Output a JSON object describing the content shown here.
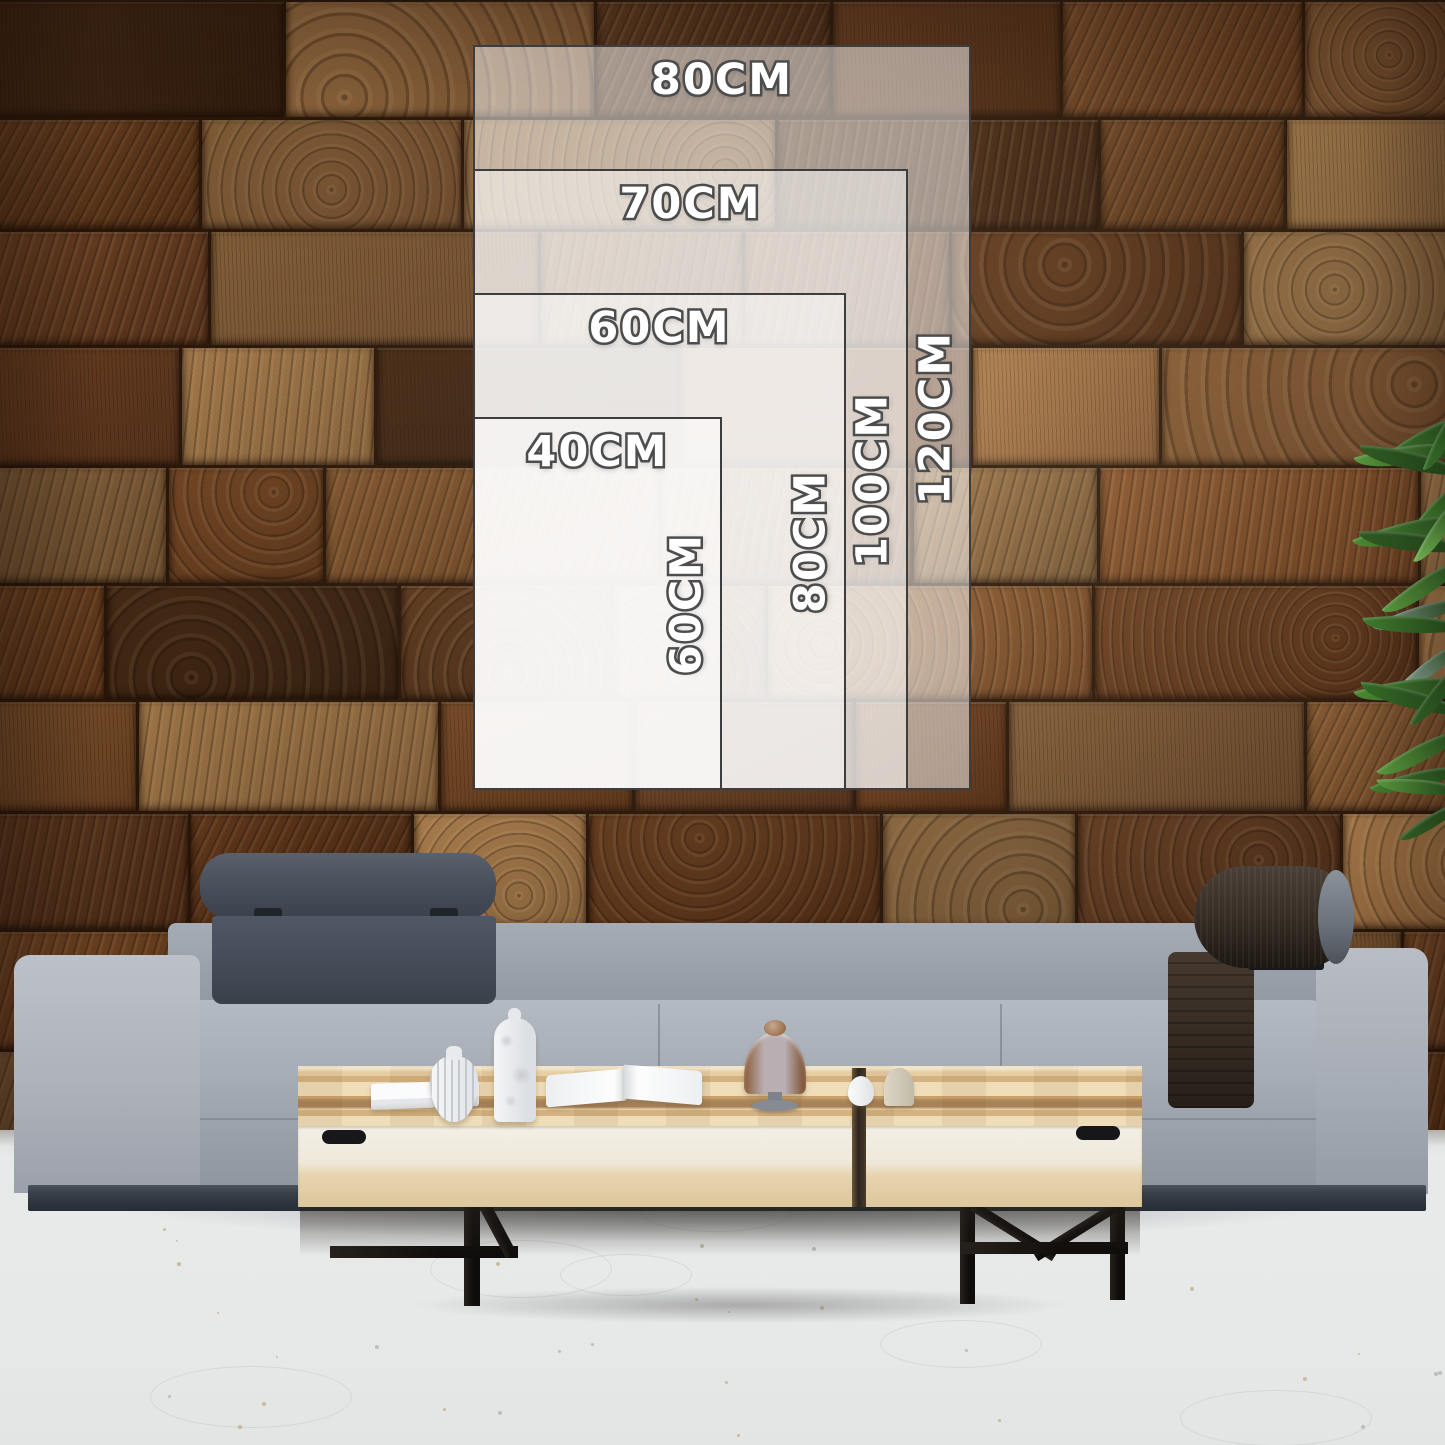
{
  "size_guide": {
    "unit": "CM",
    "sizes": [
      {
        "name": "80x120",
        "width_cm": 80,
        "height_cm": 120,
        "width_label": "80CM",
        "height_label": "120CM"
      },
      {
        "name": "70x100",
        "width_cm": 70,
        "height_cm": 100,
        "width_label": "70CM",
        "height_label": "100CM"
      },
      {
        "name": "60x80",
        "width_cm": 60,
        "height_cm": 80,
        "width_label": "60CM",
        "height_label": "80CM"
      },
      {
        "name": "40x60",
        "width_cm": 40,
        "height_cm": 60,
        "width_label": "40CM",
        "height_label": "60CM"
      }
    ],
    "label_fill": "#ffffff",
    "label_outline": "#4d4d4d",
    "panel_fill": "rgba(255,255,255,0.5)",
    "panel_border": "#3d3d3d"
  },
  "palette": {
    "wood_dark": "#4e2d16",
    "wood_mid": "#7a4c28",
    "wood_light": "#a57b4c",
    "sofa_fabric": "#a3a9b2",
    "headrest_quilt": "#454d58",
    "bolster_leather": "#2e2620",
    "table_wood": "#e2c492",
    "table_face": "#efe8da",
    "floor": "#e7e9e9",
    "plant_green": "#4a8a33"
  }
}
